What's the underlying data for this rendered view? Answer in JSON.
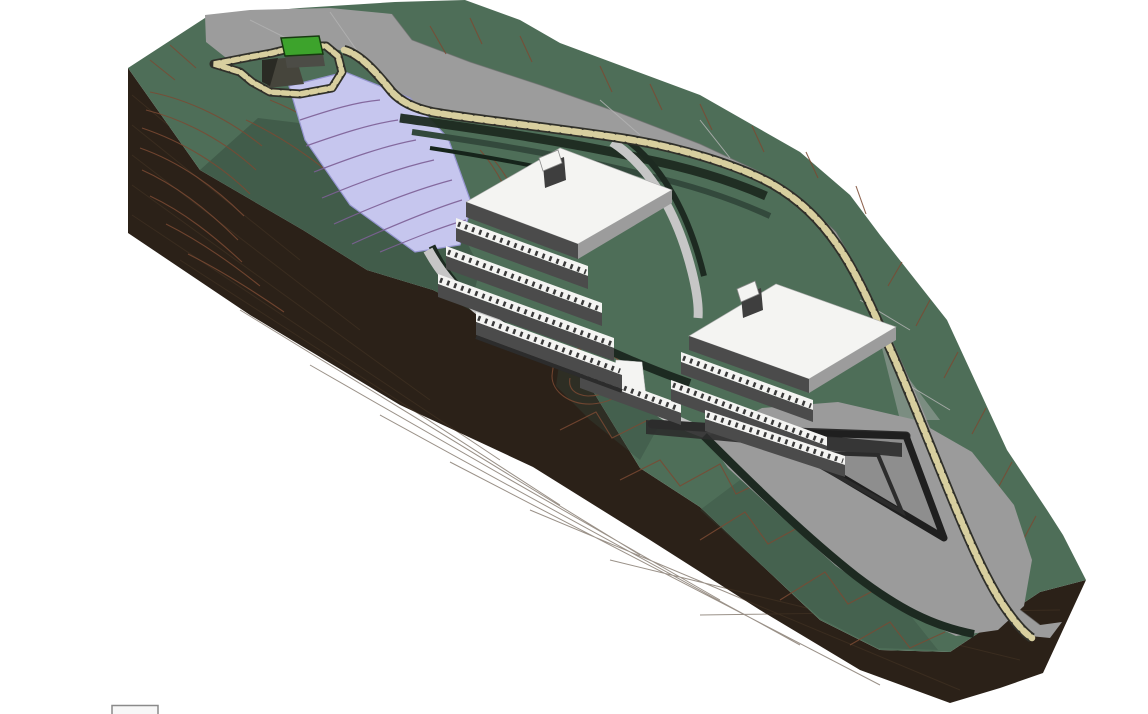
{
  "scene": {
    "description": "3D architectural site model: sloped terrain wedge with contour lines, curving road with rock retaining edge, pond, two terraced apartment buildings and a triangular lower terrace",
    "building_count": "2"
  },
  "legend": {
    "partial_box_label": ""
  },
  "colors": {
    "background": "#ffffff",
    "terrain": "#4e6e58",
    "terrain_dark": "#33493c",
    "terrain_deep": "#16241b",
    "contour": "#7b4a33",
    "cut_face": "#2b2118",
    "cut_stripe": "#473627",
    "road": "#9c9c9c",
    "road_light": "#b3b3b3",
    "road_edge": "#6f6f6f",
    "stone": "#d8cf9f",
    "stone_bg": "#30302a",
    "pool": "#c6c6ee",
    "pool_contour": "#7d6096",
    "pool_edge": "#9595cf",
    "green_box": "#3da32c",
    "green_box_face": "#4c4c46",
    "walkway": "#c6c6c6",
    "wall_dark": "#1d2a21",
    "apron": "#9b9b9b",
    "apron_inner": "#8e8e8e",
    "v_wall": "#1f1f1f",
    "building_white": "#f4f4f2",
    "building_wall": "#4b4b4b",
    "building_side": "#9c9c9c",
    "building_shadow": "#2c2c2c",
    "railing_tick": "#3a3a3a",
    "bulkhead_dark": "#3e3e3e",
    "notch": "#46453c",
    "notch_dark": "#2a2a24",
    "legend_fill": "#f7f7f7",
    "legend_border": "#8a8a8a"
  }
}
